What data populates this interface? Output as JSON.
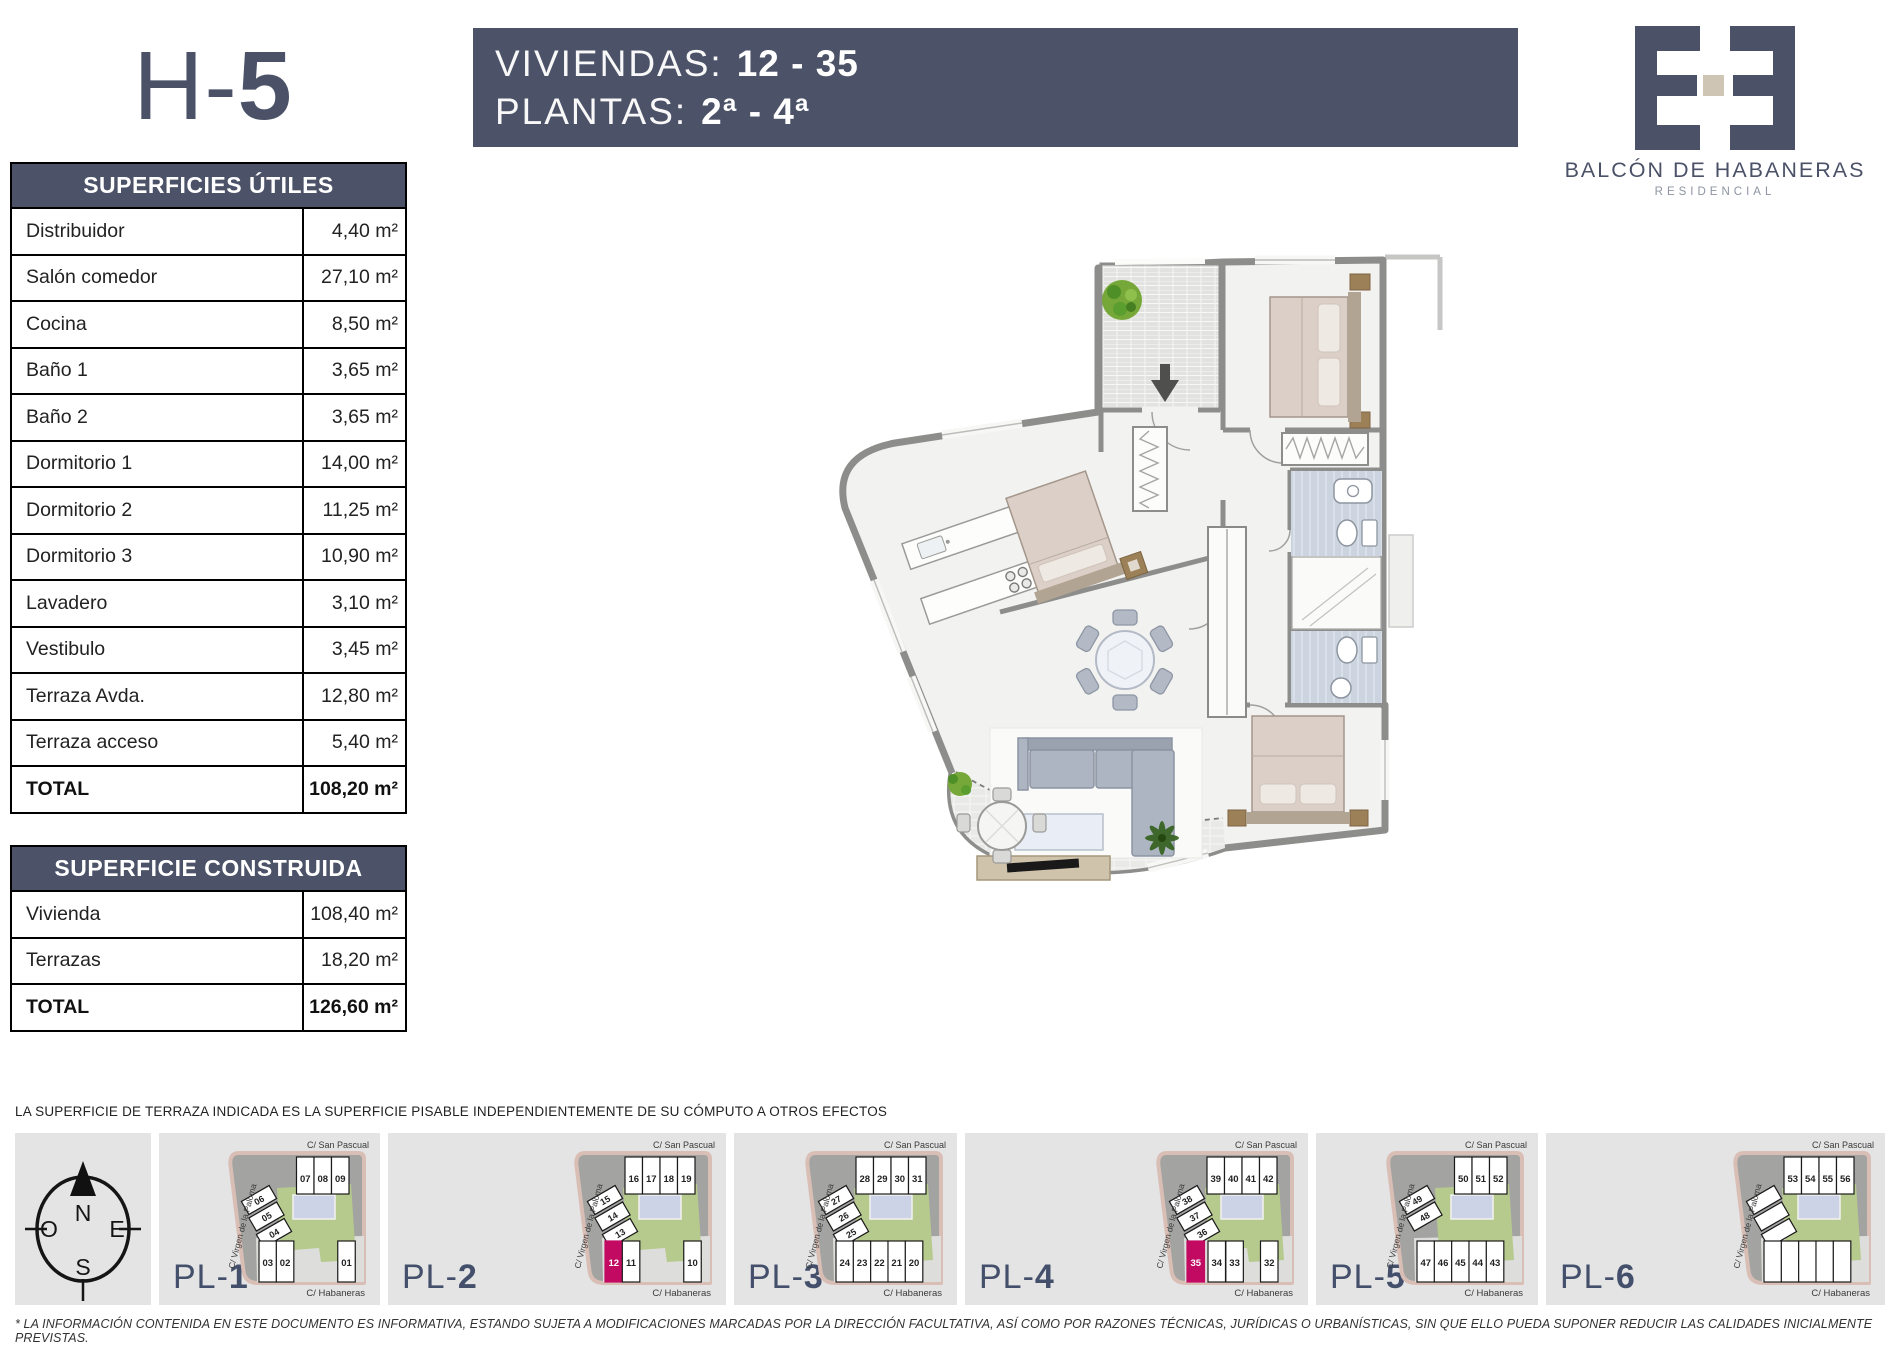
{
  "unit": {
    "title_prefix": "H-",
    "title_number": "5"
  },
  "banner": {
    "line1_label": "VIVIENDAS:",
    "line1_value": "12 - 35",
    "line2_label": "PLANTAS:",
    "line2_value": "2ª - 4ª"
  },
  "logo": {
    "name": "BALCÓN DE HABANERAS",
    "subtitle": "RESIDENCIAL"
  },
  "tables": {
    "useful": {
      "title": "SUPERFICIES ÚTILES",
      "rows": [
        {
          "label": "Distribuidor",
          "value": "4,40 m²"
        },
        {
          "label": "Salón comedor",
          "value": "27,10 m²"
        },
        {
          "label": "Cocina",
          "value": "8,50 m²"
        },
        {
          "label": "Baño 1",
          "value": "3,65 m²"
        },
        {
          "label": "Baño 2",
          "value": "3,65 m²"
        },
        {
          "label": "Dormitorio 1",
          "value": "14,00 m²"
        },
        {
          "label": "Dormitorio 2",
          "value": "11,25 m²"
        },
        {
          "label": "Dormitorio 3",
          "value": "10,90 m²"
        },
        {
          "label": "Lavadero",
          "value": "3,10 m²"
        },
        {
          "label": "Vestibulo",
          "value": "3,45 m²"
        },
        {
          "label": "Terraza Avda.",
          "value": "12,80 m²"
        },
        {
          "label": "Terraza acceso",
          "value": "5,40 m²"
        },
        {
          "label": "TOTAL",
          "value": "108,20 m²",
          "bold": true
        }
      ]
    },
    "built": {
      "title": "SUPERFICIE CONSTRUIDA",
      "rows": [
        {
          "label": "Vivienda",
          "value": "108,40 m²"
        },
        {
          "label": "Terrazas",
          "value": "18,20 m²"
        },
        {
          "label": "TOTAL",
          "value": "126,60 m²",
          "bold": true
        }
      ]
    }
  },
  "notes": {
    "terrace_note": "LA SUPERFICIE DE TERRAZA INDICADA ES LA SUPERFICIE PISABLE INDEPENDIENTEMENTE DE SU CÓMPUTO A OTROS EFECTOS",
    "disclaimer": "* LA INFORMACIÓN CONTENIDA EN ESTE DOCUMENTO ES INFORMATIVA, ESTANDO SUJETA A MODIFICACIONES MARCADAS POR LA DIRECCIÓN FACULTATIVA, ASÍ COMO POR RAZONES TÉCNICAS, JURÍDICAS O URBANÍSTICAS, SIN QUE ELLO PUEDA SUPONER REDUCIR LAS CALIDADES INICIALMENTE PREVISTAS."
  },
  "compass": {
    "north": "N",
    "south": "S",
    "east": "E",
    "west": "O"
  },
  "streets": {
    "top": "C/ San  Pascual",
    "left": "C/ Virgen de la Paloma",
    "bottom": "C/ Habaneras"
  },
  "plans_label_prefix": "PL-",
  "plans": [
    {
      "number": "1",
      "top": [
        "07",
        "08",
        "09"
      ],
      "left": [
        "06",
        "05",
        "04"
      ],
      "bottom": [
        {
          "l": "03",
          "p": 0
        },
        {
          "l": "02",
          "p": 0.165
        },
        {
          "l": "01",
          "p": 0.75
        }
      ]
    },
    {
      "number": "2",
      "top": [
        "16",
        "17",
        "18",
        "19"
      ],
      "left": [
        "15",
        "14",
        "13"
      ],
      "bottom": [
        {
          "l": "12",
          "p": 0,
          "hl": true
        },
        {
          "l": "11",
          "p": 0.165
        },
        {
          "l": "10",
          "p": 0.75
        }
      ]
    },
    {
      "number": "3",
      "top": [
        "28",
        "29",
        "30",
        "31"
      ],
      "left": [
        "27",
        "26",
        "25"
      ],
      "bottom": [
        {
          "l": "24",
          "p": 0
        },
        {
          "l": "23",
          "p": 0.165
        },
        {
          "l": "22",
          "p": 0.33
        },
        {
          "l": "21",
          "p": 0.495
        },
        {
          "l": "20",
          "p": 0.66
        }
      ]
    },
    {
      "number": "4",
      "top": [
        "39",
        "40",
        "41",
        "42"
      ],
      "left": [
        "38",
        "37",
        "36"
      ],
      "bottom": [
        {
          "l": "35",
          "p": 0,
          "hl": true
        },
        {
          "l": "34",
          "p": 0.2
        },
        {
          "l": "33",
          "p": 0.37
        },
        {
          "l": "32",
          "p": 0.7
        }
      ]
    },
    {
      "number": "5",
      "top": [
        "50",
        "51",
        "52"
      ],
      "left": [
        "49",
        "48"
      ],
      "bottom": [
        {
          "l": "47",
          "p": 0
        },
        {
          "l": "46",
          "p": 0.165
        },
        {
          "l": "45",
          "p": 0.33
        },
        {
          "l": "44",
          "p": 0.495
        },
        {
          "l": "43",
          "p": 0.66
        }
      ]
    },
    {
      "number": "6",
      "top": [
        "53",
        "54",
        "55",
        "56"
      ],
      "left": [
        "",
        "",
        ""
      ],
      "bottom": [
        {
          "l": "",
          "p": 0
        },
        {
          "l": "",
          "p": 0.165
        },
        {
          "l": "",
          "p": 0.33
        },
        {
          "l": "",
          "p": 0.495
        },
        {
          "l": "",
          "p": 0.66
        }
      ]
    }
  ],
  "colors": {
    "slate": "#4c5267",
    "highlight_magenta": "#c20a62",
    "courtyard_green": "#b6ca8e",
    "pool_blue": "#cdd3e6",
    "road_pink": "#d9beb5",
    "box_gray": "#e4e4e4",
    "wall_gray": "#8d8d8b",
    "logo_beige": "#cfc5b4"
  }
}
